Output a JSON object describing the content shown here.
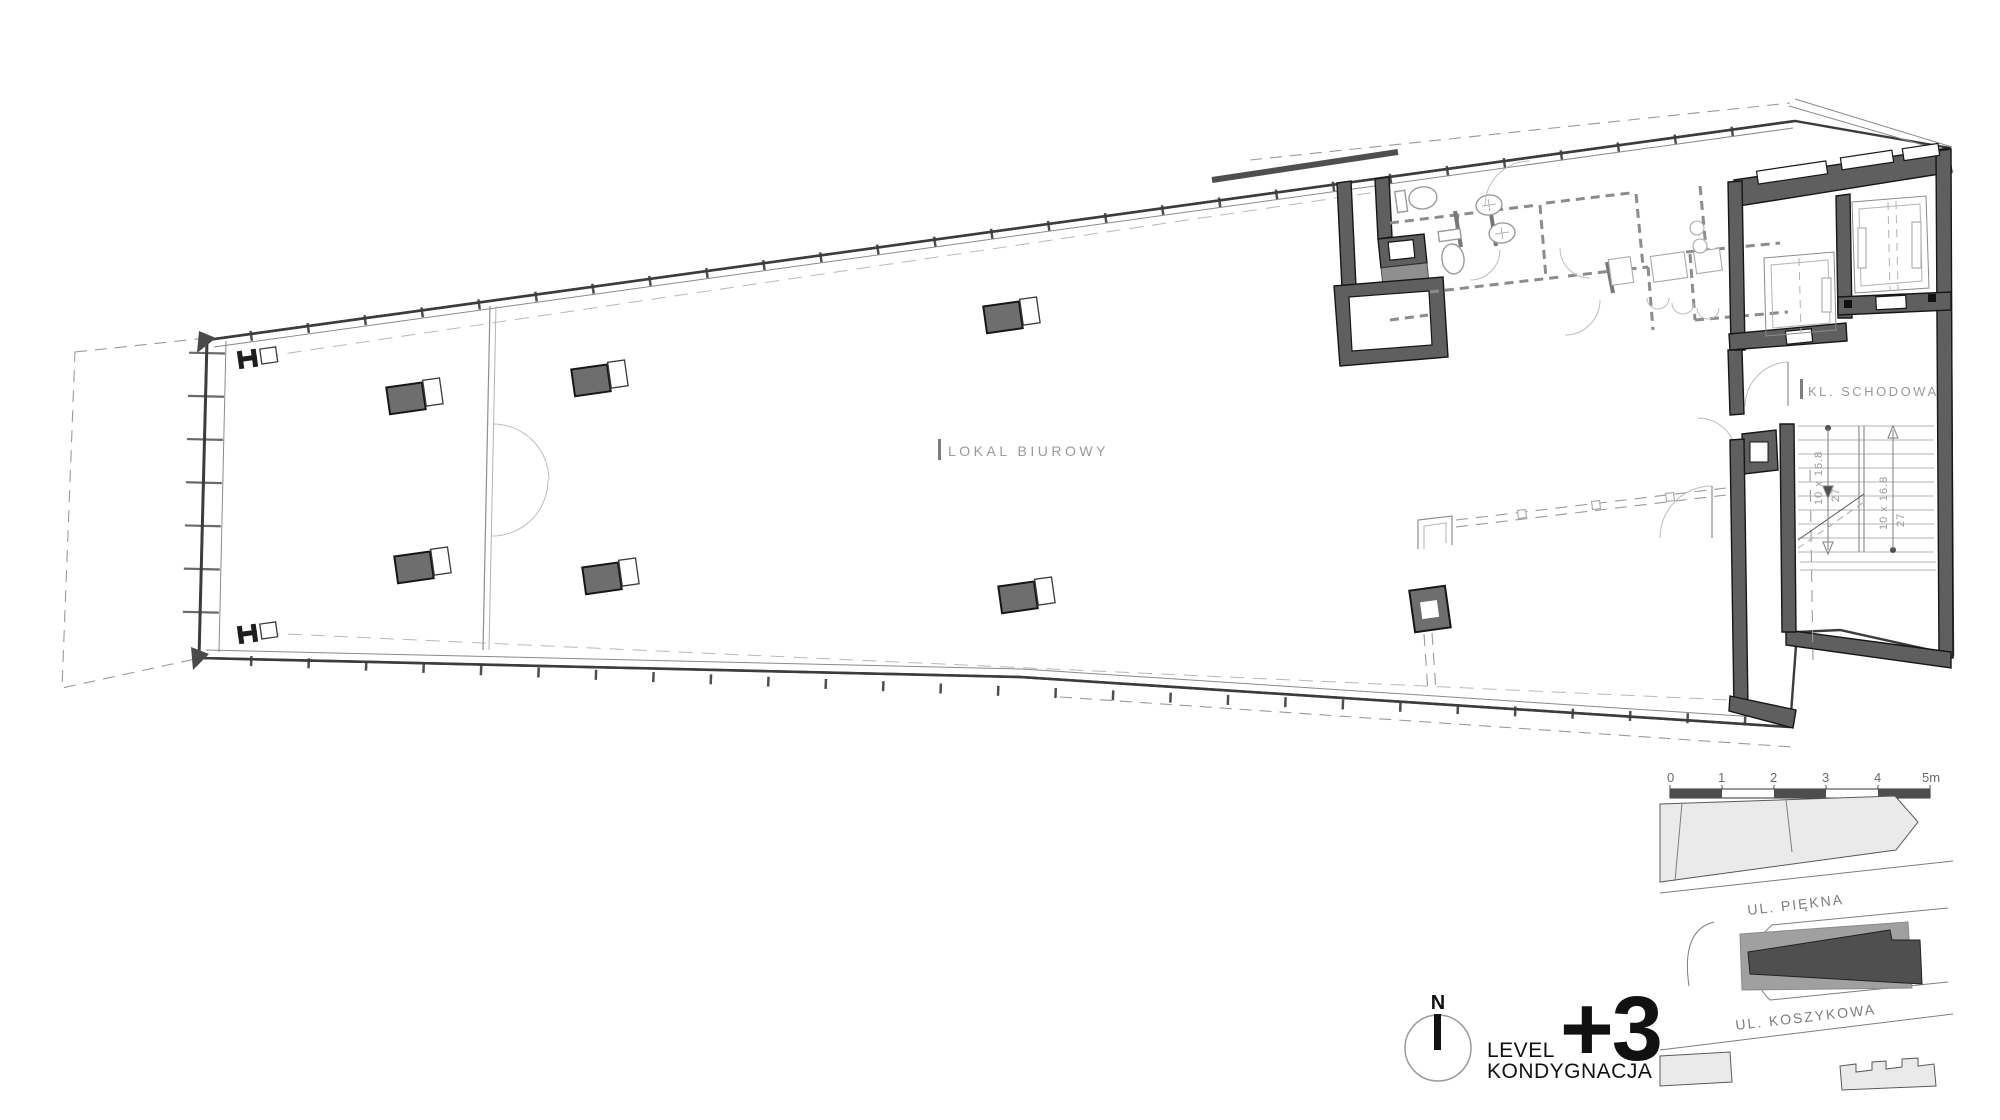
{
  "colors": {
    "wall": "#5f5f60",
    "ink": "#161616",
    "label": "#9a9a9a",
    "site_parcel": "#eaeaea",
    "site_plot": "#a0a0a0",
    "site_bldg": "#4f4f50"
  },
  "plan": {
    "office_room_label": "LOKAL BIUROWY",
    "stair_room_label": "KL. SCHODOWA",
    "stair_flight_dim": "10 x 16.8",
    "stair_tread_dim": "27"
  },
  "scale_bar": {
    "unit_labels": [
      "0",
      "1",
      "2",
      "3",
      "4",
      "5m"
    ]
  },
  "site_map": {
    "street_top": "UL. PIĘKNA",
    "street_bottom": "UL. KOSZYKOWA"
  },
  "title_block": {
    "north_label": "N",
    "level_label_line1": "LEVEL",
    "level_label_line2": "KONDYGNACJA",
    "level_value": "+3"
  }
}
